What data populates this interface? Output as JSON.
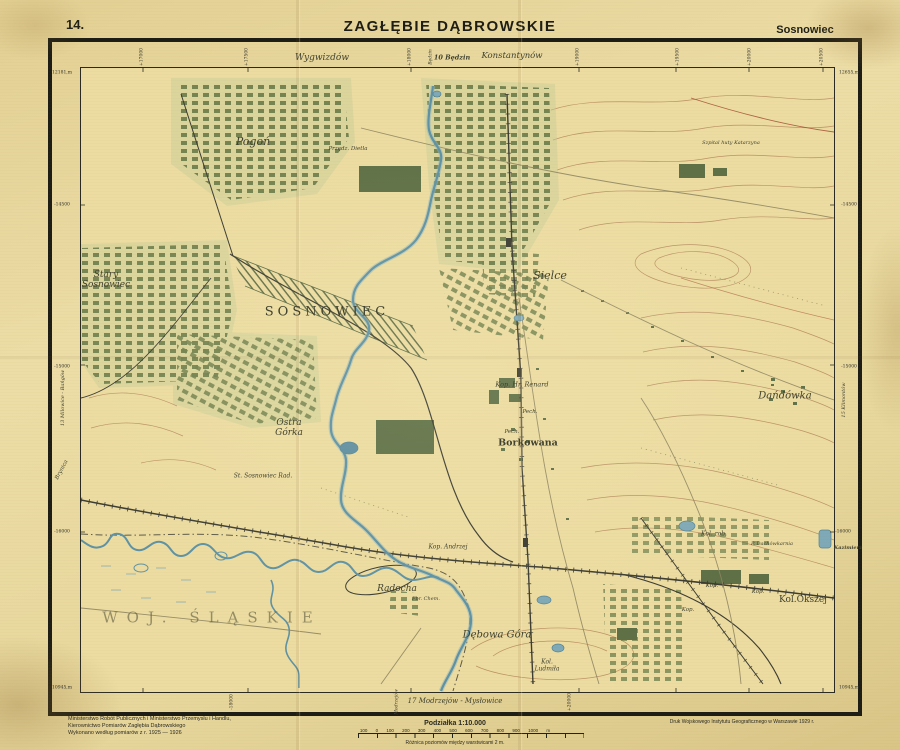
{
  "header": {
    "sheet_number": "14.",
    "title": "ZAGŁĘBIE DĄBROWSKIE",
    "sheet_name": "Sosnowiec"
  },
  "neighbors": {
    "top_left": "Wygwizdów",
    "top_vertical": "Będzin",
    "top_center": "10 Będzin",
    "top_right": "Konstantynów",
    "left_vertical": "13 Milowice - Bańgów",
    "left_river": "Brynica",
    "right_vertical": "15 Klimontów",
    "right_road": "Kazimierz",
    "bottom_center": "17 Modrzejów - Mysłowice",
    "bottom_vertical": "Modrzejów"
  },
  "grid": {
    "left": [
      "12181,m",
      "-14500",
      "-15000",
      "-16000",
      "10945,m"
    ],
    "right": [
      "12655,m",
      "-14500",
      "-15000",
      "-16000",
      "10945,m"
    ],
    "top": [
      "+17000",
      "+17500",
      "+18000",
      "+19000",
      "+19500",
      "+20000",
      "+20500"
    ],
    "bottom": [
      "-18000",
      "+20000"
    ]
  },
  "map_labels": {
    "pogon": "Pogoń",
    "przedz_dietla": "Przędz. Dietla",
    "szpital": "Szpital huty Katarzyna",
    "stary_sosnowiec": "Stary\nSosnowiec",
    "sosnowiec": "SOSNOWIEC",
    "sielce": "Sielce",
    "kop_hr_renard": "Kop. Hr. Renard",
    "ostra_gorka": "Ostra\nGórka",
    "st_sosnowiec_rad": "St. Sosnowiec Rad.",
    "borkowana": "Borkowana",
    "dandowka": "Dańdówka",
    "pech1": "Pech.",
    "pech2": "Pech.",
    "radocha": "Radocha",
    "fbr_chem": "Fbr. Chem.",
    "kop_andrzej": "Kop. Andrzej",
    "debowa_gora": "Dębowa Góra",
    "kol_ludmila": "Kol.\nLudmiła",
    "woj_slaskie": "WOJ. ŚLĄSKIE",
    "kol_rob": "Kol. rob.",
    "p_dachowkarnia": "P. Dachówkarnia",
    "kol_okszej": "Kol.Okszej",
    "kop1": "Kop.",
    "kop2": "Kop.",
    "kop3": "Kop."
  },
  "footer": {
    "credit1": "Ministerstwo Robót Publicznych i Ministerstwo Przemysłu i Handlu,",
    "credit2": "Kierownictwo Pomiarów Zagłębia Dąbrowskiego",
    "credit3": "Wykonano według pomiarów z r. 1925 — 1926",
    "scale_title": "Podziałka 1:10.000",
    "scale_numbers": "100 0 100 200 300 400 500 600 700 800 900 1000 m",
    "scale_note": "Różnica poziomów między warstwicami 2 m.",
    "print": "Druk Wojskowego Instytutu Geograficznego w Warszawie 1929 r."
  },
  "colors": {
    "paper": "#ecdca1",
    "ink": "#1d1d15",
    "urban_green": "#6d7d4b",
    "water_blue": "#5e92a4",
    "contour_brown": "#b08055"
  }
}
